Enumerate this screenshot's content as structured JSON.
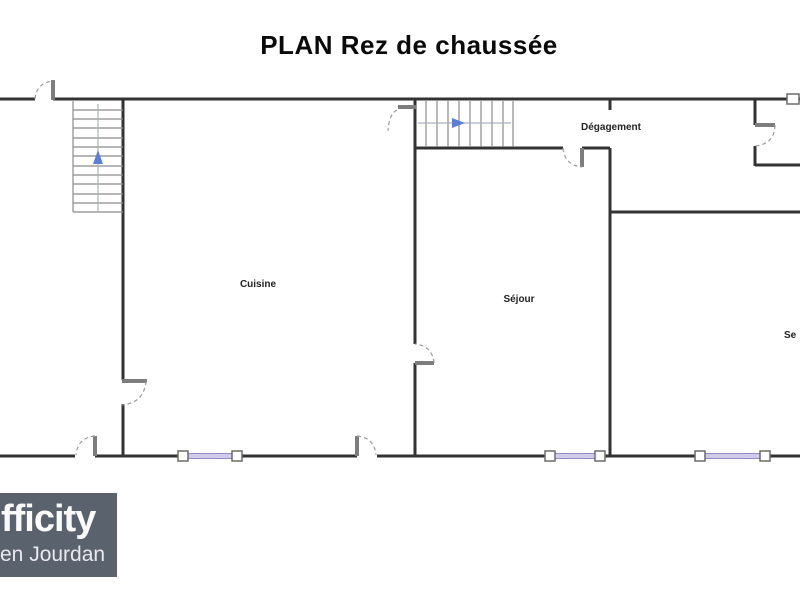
{
  "title": "PLAN Rez de chaussée",
  "floor_plan": {
    "rooms": {
      "cuisine": {
        "label": "Cuisine"
      },
      "sejour": {
        "label": "Séjour"
      },
      "degagement": {
        "label": "Dégagement"
      },
      "partial_right": {
        "label": "Se"
      }
    },
    "stairs": [
      {
        "name": "staircase-left",
        "direction_arrow": "up"
      },
      {
        "name": "staircase-corridor",
        "direction_arrow": "right"
      }
    ],
    "features": {
      "doors": 8,
      "windows": 3
    }
  },
  "logo": {
    "line1": "fficity",
    "line2": "en Jourdan"
  },
  "colors": {
    "background": "#ffffff",
    "wall": "#333333",
    "stair_tread": "#8a8a8a",
    "door_leaf": "#7d7d7d",
    "door_arc": "#9a9a9a",
    "window_fill": "#cfcbe8",
    "window_border": "#938bc5",
    "arrow_blue": "#5b7fd9",
    "label_text": "#222222",
    "logo_background": "#5a626e",
    "logo_text": "#f5f5f7"
  }
}
